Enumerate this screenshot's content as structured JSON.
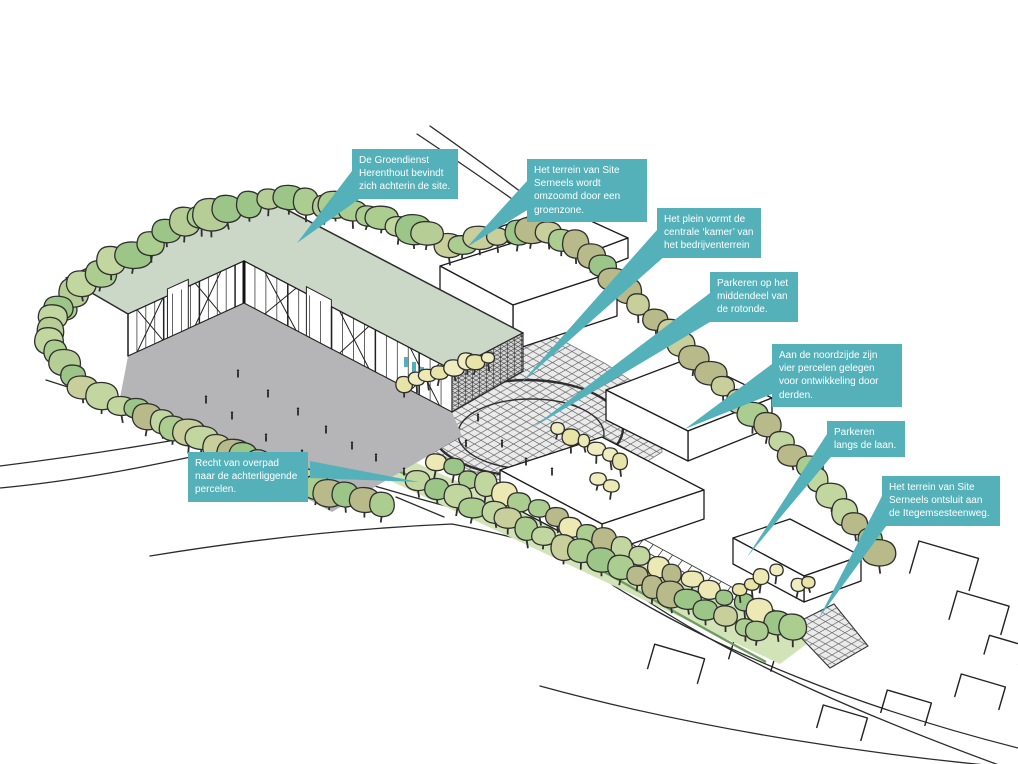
{
  "diagram": {
    "language": "nl",
    "style": "axonometric site sketch with callout annotations"
  },
  "annotations": [
    {
      "text": "De Groendienst Herenthout bevindt zich achterin de site."
    },
    {
      "text": "Het terrein van Site Serneels wordt omzoomd door een groenzone."
    },
    {
      "text": "Het plein vormt de centrale ‘kamer’ van het bedrijventerrein"
    },
    {
      "text": "Parkeren op het middendeel van de rotonde."
    },
    {
      "text": "Aan de noordzijde zijn vier percelen gelegen voor ontwikkeling door derden."
    },
    {
      "text": "Parkeren langs de laan."
    },
    {
      "text": "Het terrein van Site Serneels ontsluit aan de Itegemsesteenweg."
    },
    {
      "text": "Recht van overpad naar de achterliggende percelen."
    }
  ],
  "colors": {
    "label_bg": "#54b1ba",
    "label_text": "#ffffff",
    "roof": "#cbd8c8",
    "courtyard": "#b5b5b7",
    "plaza_bg": "#ebebeb",
    "hatch_line": "#5d5d5d",
    "sketch_line": "#2b2b2b",
    "building_fill": "#ffffff",
    "grass_strip": "#d2e3b8",
    "hedge": "#6f9c5f",
    "tree_greens": [
      "#abce90",
      "#c2d7a0",
      "#9cc687",
      "#b7cd96",
      "#b9ba8a",
      "#c8cf9b"
    ],
    "tree_pale": "#ece9b4",
    "door_accent": "#53b0b9"
  }
}
